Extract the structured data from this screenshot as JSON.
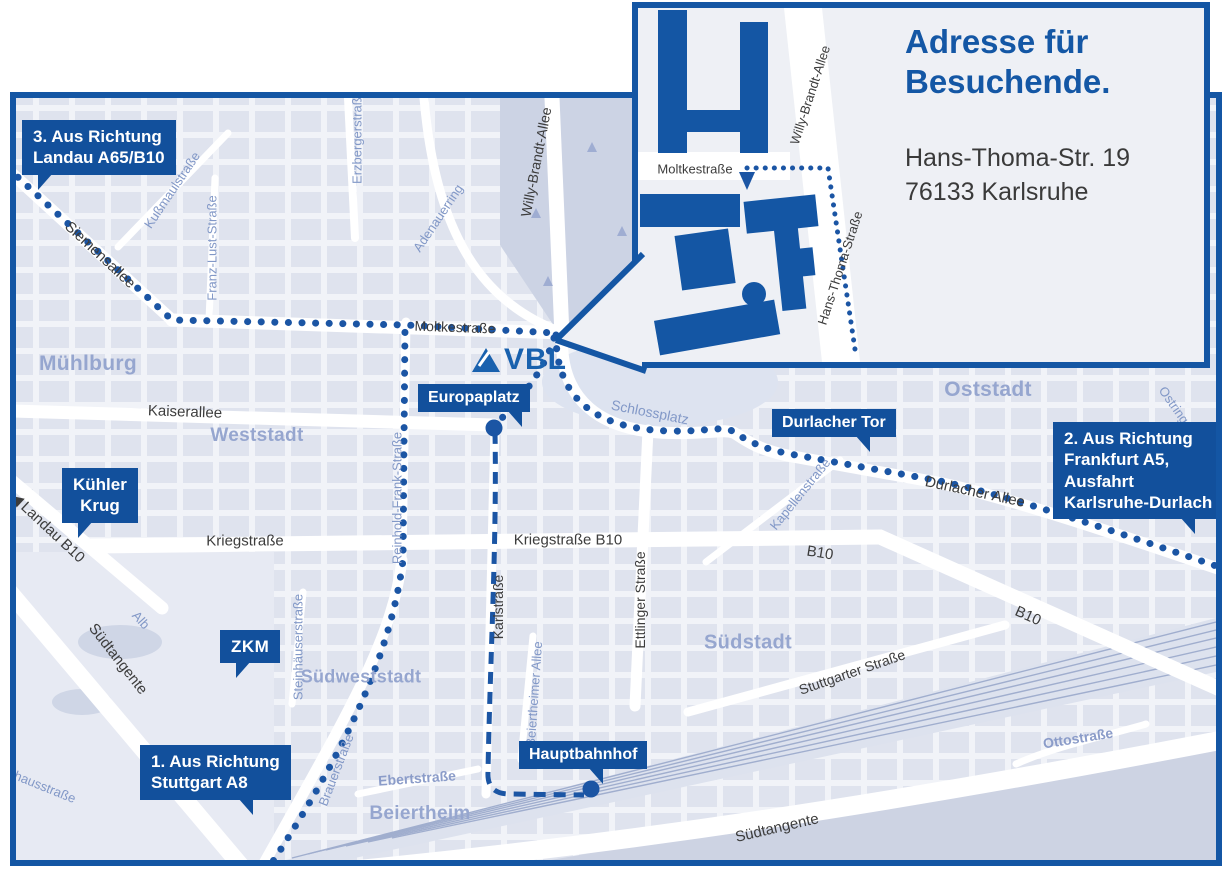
{
  "inset": {
    "heading": [
      "Adresse für",
      "Besuchende."
    ],
    "address": [
      "Hans-Thoma-Str. 19",
      "76133 Karlsruhe"
    ],
    "streets": {
      "moltkestrasse": "Moltkestraße",
      "willy_brandt": "Willy-Brandt-Allee",
      "hans_thoma": "Hans-Thoma-Straße"
    }
  },
  "logo": {
    "text": "VBL"
  },
  "directions": {
    "stuttgart": [
      "1. Aus Richtung",
      "Stuttgart A8"
    ],
    "frankfurt": [
      "2. Aus Richtung",
      "Frankfurt A5,",
      "Ausfahrt",
      "Karlsruhe-Durlach"
    ],
    "landau": [
      "3. Aus Richtung",
      "Landau A65/B10"
    ]
  },
  "pois": {
    "europaplatz": "Europaplatz",
    "kuehler_krug": [
      "Kühler",
      "Krug"
    ],
    "durlacher_tor": "Durlacher Tor",
    "zkm": "ZKM",
    "hauptbahnhof": "Hauptbahnhof"
  },
  "districts": {
    "muehlburg": "Mühlburg",
    "weststadt": "Weststadt",
    "oststadt": "Oststadt",
    "suedstadt": "Südstadt",
    "suedweststadt": "Südweststadt",
    "beiertheim": "Beiertheim"
  },
  "streets": {
    "siemensallee": "Siemensallee",
    "kaiserallee": "Kaiserallee",
    "moltkestrasse": "Moltkestraße",
    "kriegstrasse": "Kriegstraße",
    "kriegstrasse_b10": "Kriegstraße B10",
    "b10_east": "B10",
    "b10_south": "B10",
    "karlstrasse": "Karlstraße",
    "ettlinger_strasse": "Ettlinger Straße",
    "willy_brandt_allee": "Willy-Brandt-Allee",
    "durlacher_allee": "Durlacher Allee",
    "stuttgarter_strasse": "Stuttgarter Straße",
    "suedtangente_west": "Südtangente",
    "suedtangente_sued": "Südtangente",
    "landau_b10": "Landau B10",
    "kussmaulstrasse": "Kußmaulstraße",
    "franz_lust_strasse": "Franz-Lust-Straße",
    "erzbergerstrasse": "Erzbergerstraße",
    "adenauerring": "Adenauerring",
    "reinhold_frank_strasse": "Reinhold-Frank-Straße",
    "schlossplatz": "Schlossplatz",
    "kapellenstrasse": "Kapellenstraße",
    "ostring": "Ostring",
    "steinhaeuserstrasse": "Steinhäuserstraße",
    "beiertheimer_allee": "Beiertheimer Allee",
    "brauerstrasse": "Brauerstraße",
    "ebertstrasse": "Ebertstraße",
    "ottostrasse": "Ottostraße",
    "alb": "Alb",
    "pulverhausstrasse": "Pulverhausstraße"
  },
  "colors": {
    "border_blue": "#1456a4",
    "label_box_blue": "#12509c",
    "heading_blue": "#1457a5",
    "route_blue": "#1b55a4",
    "street_dark": "#3c3c3c",
    "street_blue": "#8298c7",
    "district_blue": "#96a6cf",
    "map_block": "#dfe3ee",
    "map_bg": "#f1f3f8",
    "park_dark": "#ccd3e4"
  }
}
